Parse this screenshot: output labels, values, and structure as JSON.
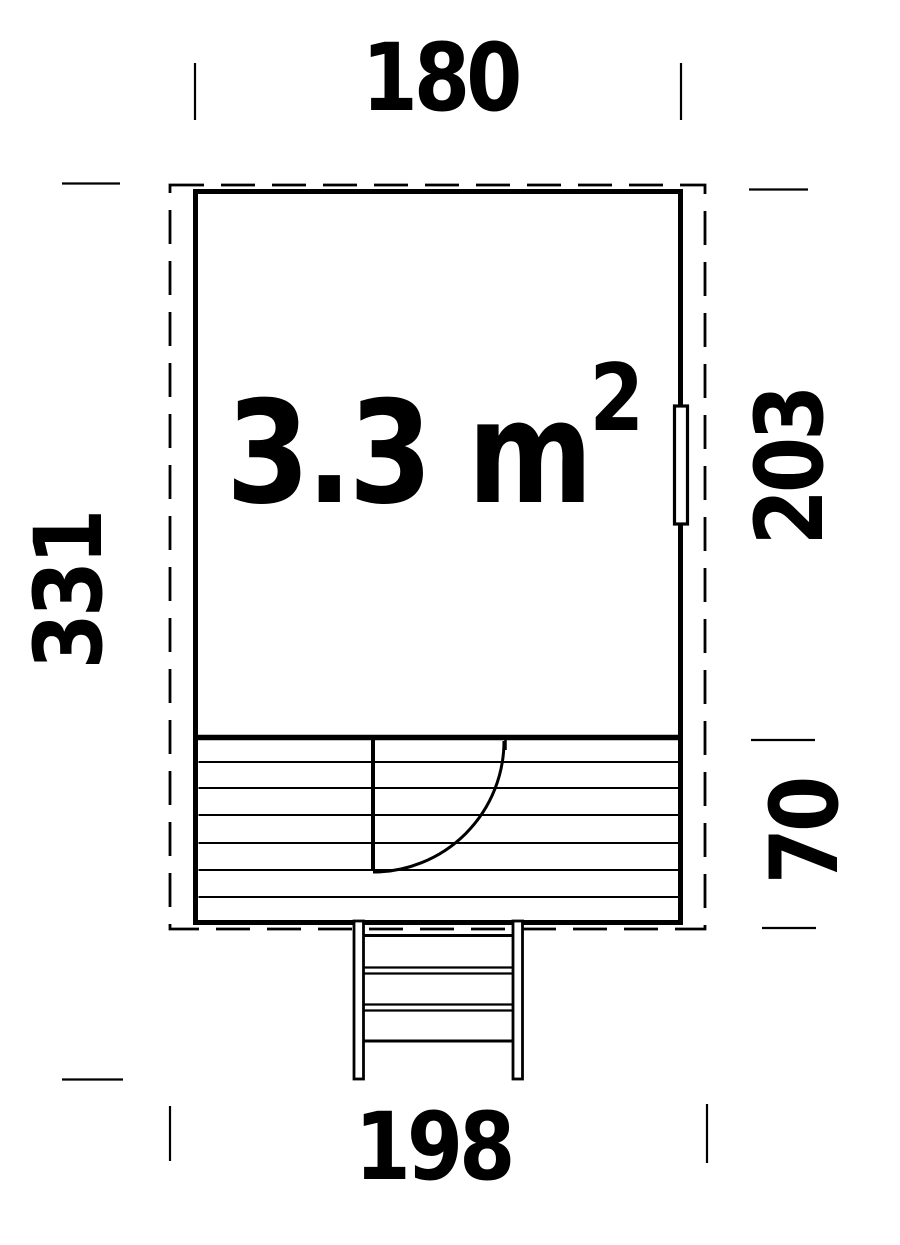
{
  "floor_plan": {
    "area_label": {
      "main": "3.3 m",
      "superscript": "2"
    },
    "dimensions": {
      "building_width_top": "180",
      "total_depth_left": "331",
      "room_depth_right": "203",
      "porch_depth_right": "70",
      "overall_width_bottom": "198"
    },
    "colors": {
      "line": "#000000",
      "background": "#ffffff"
    }
  }
}
